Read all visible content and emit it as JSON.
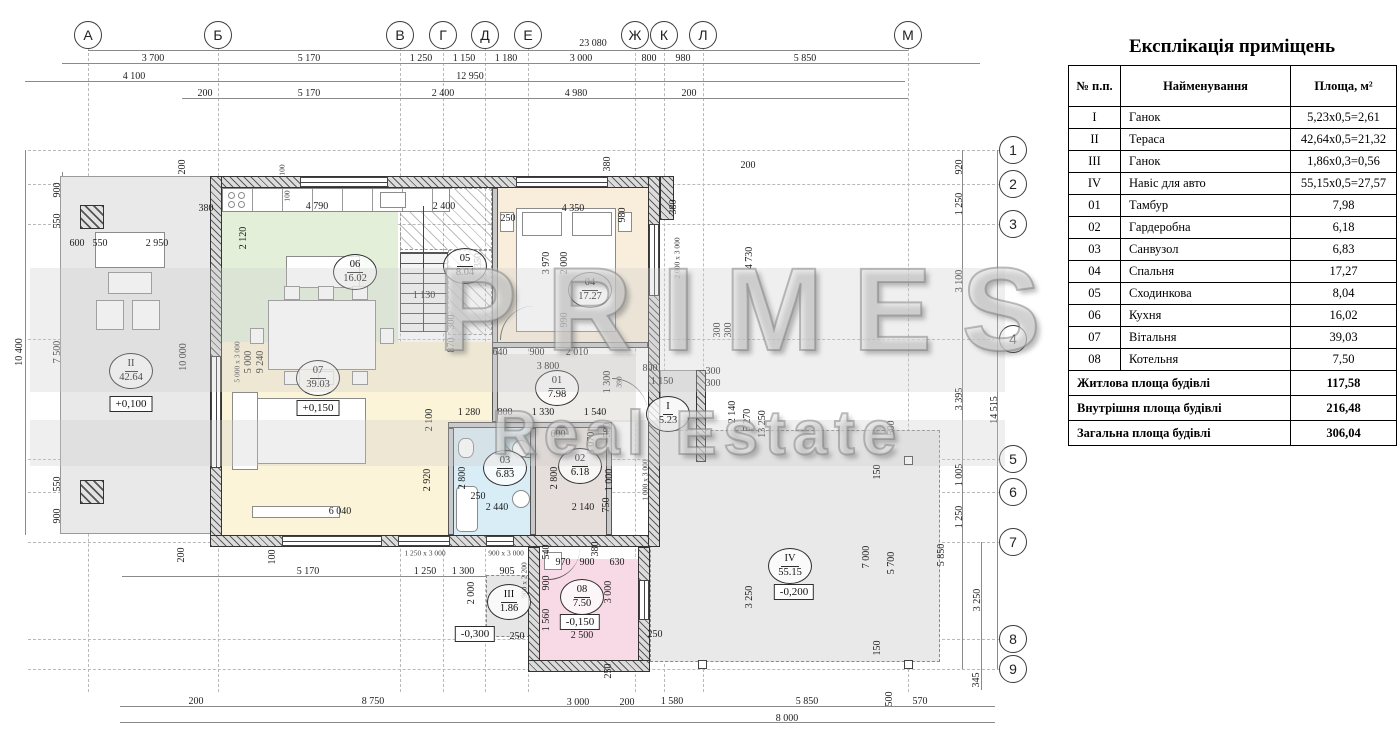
{
  "explication": {
    "title": "Експлікація приміщень",
    "headers": [
      "№ п.п.",
      "Найменування",
      "Площа, м²"
    ],
    "rows": [
      [
        "I",
        "Ганок",
        "5,23x0,5=2,61"
      ],
      [
        "II",
        "Тераса",
        "42,64x0,5=21,32"
      ],
      [
        "III",
        "Ганок",
        "1,86x0,3=0,56"
      ],
      [
        "IV",
        "Навіс для авто",
        "55,15x0,5=27,57"
      ],
      [
        "01",
        "Тамбур",
        "7,98"
      ],
      [
        "02",
        "Гардеробна",
        "6,18"
      ],
      [
        "03",
        "Санвузол",
        "6,83"
      ],
      [
        "04",
        "Спальня",
        "17,27"
      ],
      [
        "05",
        "Сходинкова",
        "8,04"
      ],
      [
        "06",
        "Кухня",
        "16,02"
      ],
      [
        "07",
        "Вітальня",
        "39,03"
      ],
      [
        "08",
        "Котельня",
        "7,50"
      ]
    ],
    "summary": [
      [
        "Житлова площа будівлі",
        "117,58"
      ],
      [
        "Внутрішня площа будівлі",
        "216,48"
      ],
      [
        "Загальна площа будівлі",
        "306,04"
      ]
    ]
  },
  "watermark": {
    "line1": "PRIMES",
    "line2": "Real Estate"
  },
  "axes": {
    "top": [
      {
        "label": "А",
        "x": 88
      },
      {
        "label": "Б",
        "x": 218
      },
      {
        "label": "В",
        "x": 400
      },
      {
        "label": "Г",
        "x": 443
      },
      {
        "label": "Д",
        "x": 485
      },
      {
        "label": "Е",
        "x": 528
      },
      {
        "label": "Ж",
        "x": 635
      },
      {
        "label": "К",
        "x": 664
      },
      {
        "label": "Л",
        "x": 703
      },
      {
        "label": "М",
        "x": 908
      }
    ],
    "right": [
      {
        "label": "1",
        "y": 150
      },
      {
        "label": "2",
        "y": 184
      },
      {
        "label": "3",
        "y": 224
      },
      {
        "label": "4",
        "y": 339
      },
      {
        "label": "5",
        "y": 459
      },
      {
        "label": "6",
        "y": 492
      },
      {
        "label": "7",
        "y": 542
      },
      {
        "label": "8",
        "y": 639
      },
      {
        "label": "9",
        "y": 669
      }
    ]
  },
  "rooms": [
    {
      "num": "06",
      "area": "16.02",
      "x": 355,
      "y": 272
    },
    {
      "num": "05",
      "area": "8.04",
      "x": 465,
      "y": 266
    },
    {
      "num": "04",
      "area": "17.27",
      "x": 590,
      "y": 290
    },
    {
      "num": "07",
      "area": "39.03",
      "x": 318,
      "y": 378
    },
    {
      "num": "01",
      "area": "7.98",
      "x": 557,
      "y": 388
    },
    {
      "num": "I",
      "area": "5.23",
      "x": 668,
      "y": 414
    },
    {
      "num": "03",
      "area": "6.83",
      "x": 505,
      "y": 468
    },
    {
      "num": "02",
      "area": "6.18",
      "x": 580,
      "y": 466
    },
    {
      "num": "08",
      "area": "7.50",
      "x": 582,
      "y": 597
    },
    {
      "num": "III",
      "area": "1.86",
      "x": 509,
      "y": 602
    },
    {
      "num": "IV",
      "area": "55.15",
      "x": 790,
      "y": 566
    },
    {
      "num": "II",
      "area": "42.64",
      "x": 131,
      "y": 371
    }
  ],
  "elevations": [
    {
      "text": "+0,100",
      "x": 131,
      "y": 404
    },
    {
      "text": "+0,150",
      "x": 318,
      "y": 408
    },
    {
      "text": "-0,150",
      "x": 580,
      "y": 622
    },
    {
      "text": "-0,300",
      "x": 475,
      "y": 634
    },
    {
      "text": "-0,200",
      "x": 794,
      "y": 592
    }
  ],
  "dims": [
    {
      "t": "23 080",
      "x": 593,
      "y": 44
    },
    {
      "t": "3 700",
      "x": 153,
      "y": 59
    },
    {
      "t": "5 170",
      "x": 309,
      "y": 59
    },
    {
      "t": "1 250",
      "x": 421,
      "y": 59
    },
    {
      "t": "1 150",
      "x": 464,
      "y": 59
    },
    {
      "t": "1 180",
      "x": 506,
      "y": 59
    },
    {
      "t": "3 000",
      "x": 581,
      "y": 59
    },
    {
      "t": "800",
      "x": 649,
      "y": 59
    },
    {
      "t": "980",
      "x": 683,
      "y": 59
    },
    {
      "t": "5 850",
      "x": 805,
      "y": 59
    },
    {
      "t": "4 100",
      "x": 134,
      "y": 77
    },
    {
      "t": "12 950",
      "x": 470,
      "y": 77
    },
    {
      "t": "200",
      "x": 205,
      "y": 94
    },
    {
      "t": "5 170",
      "x": 309,
      "y": 94
    },
    {
      "t": "2 400",
      "x": 443,
      "y": 94
    },
    {
      "t": "4 980",
      "x": 576,
      "y": 94
    },
    {
      "t": "200",
      "x": 689,
      "y": 94
    },
    {
      "t": "10 400",
      "x": 20,
      "y": 352,
      "r": 1
    },
    {
      "t": "900",
      "x": 58,
      "y": 190,
      "r": 1
    },
    {
      "t": "550",
      "x": 58,
      "y": 221,
      "r": 1
    },
    {
      "t": "7 500",
      "x": 58,
      "y": 352,
      "r": 1
    },
    {
      "t": "550",
      "x": 58,
      "y": 484,
      "r": 1
    },
    {
      "t": "900",
      "x": 58,
      "y": 516,
      "r": 1
    },
    {
      "t": "600",
      "x": 77,
      "y": 244
    },
    {
      "t": "550",
      "x": 100,
      "y": 244
    },
    {
      "t": "2 950",
      "x": 157,
      "y": 244
    },
    {
      "t": "200",
      "x": 183,
      "y": 167,
      "r": 1
    },
    {
      "t": "380",
      "x": 206,
      "y": 209
    },
    {
      "t": "10 000",
      "x": 184,
      "y": 357,
      "r": 1
    },
    {
      "t": "2 120",
      "x": 244,
      "y": 238,
      "r": 1
    },
    {
      "t": "100",
      "x": 282,
      "y": 170,
      "r": 1,
      "s": 1
    },
    {
      "t": "100",
      "x": 287,
      "y": 196,
      "r": 1,
      "s": 1
    },
    {
      "t": "4 790",
      "x": 317,
      "y": 207
    },
    {
      "t": "2 400",
      "x": 444,
      "y": 207
    },
    {
      "t": "380",
      "x": 608,
      "y": 164,
      "r": 1
    },
    {
      "t": "250",
      "x": 508,
      "y": 219
    },
    {
      "t": "4 350",
      "x": 573,
      "y": 209
    },
    {
      "t": "980",
      "x": 623,
      "y": 215,
      "r": 1
    },
    {
      "t": "380",
      "x": 674,
      "y": 207,
      "r": 1
    },
    {
      "t": "200",
      "x": 748,
      "y": 166
    },
    {
      "t": "3350",
      "x": 479,
      "y": 263,
      "r": 1
    },
    {
      "t": "1 130",
      "x": 424,
      "y": 296
    },
    {
      "t": "5 000 x 3 000",
      "x": 237,
      "y": 362,
      "r": 1,
      "s": 1
    },
    {
      "t": "5 000",
      "x": 249,
      "y": 362,
      "r": 1
    },
    {
      "t": "9 240",
      "x": 261,
      "y": 362,
      "r": 1
    },
    {
      "t": "300",
      "x": 452,
      "y": 322,
      "r": 1
    },
    {
      "t": "870",
      "x": 452,
      "y": 345,
      "r": 1
    },
    {
      "t": "2 100",
      "x": 430,
      "y": 420,
      "r": 1
    },
    {
      "t": "6 040",
      "x": 340,
      "y": 512
    },
    {
      "t": "3 970",
      "x": 547,
      "y": 263,
      "r": 1
    },
    {
      "t": "2 000",
      "x": 565,
      "y": 263,
      "r": 1
    },
    {
      "t": "2 000 x 3 000",
      "x": 677,
      "y": 258,
      "r": 1,
      "s": 1
    },
    {
      "t": "990",
      "x": 565,
      "y": 320,
      "r": 1
    },
    {
      "t": "4 730",
      "x": 750,
      "y": 258,
      "r": 1
    },
    {
      "t": "640",
      "x": 500,
      "y": 353
    },
    {
      "t": "900",
      "x": 537,
      "y": 353
    },
    {
      "t": "2 010",
      "x": 577,
      "y": 353
    },
    {
      "t": "3 800",
      "x": 548,
      "y": 367
    },
    {
      "t": "800",
      "x": 650,
      "y": 369
    },
    {
      "t": "1 150",
      "x": 662,
      "y": 382
    },
    {
      "t": "300",
      "x": 713,
      "y": 372
    },
    {
      "t": "300",
      "x": 713,
      "y": 384
    },
    {
      "t": "300",
      "x": 718,
      "y": 330,
      "r": 1
    },
    {
      "t": "300",
      "x": 729,
      "y": 330,
      "r": 1
    },
    {
      "t": "1 300",
      "x": 608,
      "y": 382,
      "r": 1
    },
    {
      "t": "390",
      "x": 619,
      "y": 382,
      "r": 1,
      "s": 1
    },
    {
      "t": "2 140",
      "x": 733,
      "y": 412,
      "r": 1
    },
    {
      "t": "5 270",
      "x": 748,
      "y": 420,
      "r": 1
    },
    {
      "t": "13 250",
      "x": 763,
      "y": 424,
      "r": 1
    },
    {
      "t": "1 280",
      "x": 469,
      "y": 413
    },
    {
      "t": "800",
      "x": 505,
      "y": 413
    },
    {
      "t": "1 330",
      "x": 543,
      "y": 413
    },
    {
      "t": "1 540",
      "x": 595,
      "y": 413
    },
    {
      "t": "2 920",
      "x": 428,
      "y": 480,
      "r": 1
    },
    {
      "t": "2 800",
      "x": 463,
      "y": 478,
      "r": 1
    },
    {
      "t": "600",
      "x": 558,
      "y": 435
    },
    {
      "t": "2 800",
      "x": 555,
      "y": 478,
      "r": 1
    },
    {
      "t": "5 070",
      "x": 592,
      "y": 443,
      "r": 1
    },
    {
      "t": "580",
      "x": 608,
      "y": 430,
      "r": 1
    },
    {
      "t": "1 000",
      "x": 610,
      "y": 480,
      "r": 1
    },
    {
      "t": "750",
      "x": 607,
      "y": 505,
      "r": 1
    },
    {
      "t": "250",
      "x": 478,
      "y": 497
    },
    {
      "t": "2 440",
      "x": 497,
      "y": 508
    },
    {
      "t": "2 140",
      "x": 583,
      "y": 508
    },
    {
      "t": "1 000 x 3 000",
      "x": 645,
      "y": 480,
      "r": 1,
      "s": 1
    },
    {
      "t": "100",
      "x": 273,
      "y": 557,
      "r": 1
    },
    {
      "t": "200",
      "x": 182,
      "y": 555,
      "r": 1
    },
    {
      "t": "1 250 x 3 000",
      "x": 425,
      "y": 553,
      "s": 1
    },
    {
      "t": "900 x 3 000",
      "x": 506,
      "y": 553,
      "s": 1
    },
    {
      "t": "5 170",
      "x": 308,
      "y": 572
    },
    {
      "t": "1 250",
      "x": 425,
      "y": 572
    },
    {
      "t": "1 300",
      "x": 463,
      "y": 572
    },
    {
      "t": "905",
      "x": 507,
      "y": 572
    },
    {
      "t": "900 x 2 200",
      "x": 524,
      "y": 580,
      "r": 1,
      "s": 1
    },
    {
      "t": "2 000",
      "x": 472,
      "y": 593,
      "r": 1
    },
    {
      "t": "540",
      "x": 547,
      "y": 552,
      "r": 1
    },
    {
      "t": "970",
      "x": 563,
      "y": 563
    },
    {
      "t": "900",
      "x": 587,
      "y": 563
    },
    {
      "t": "630",
      "x": 617,
      "y": 563
    },
    {
      "t": "380",
      "x": 596,
      "y": 549,
      "r": 1
    },
    {
      "t": "900",
      "x": 547,
      "y": 583,
      "r": 1
    },
    {
      "t": "1 560",
      "x": 547,
      "y": 620,
      "r": 1
    },
    {
      "t": "3 000",
      "x": 609,
      "y": 592,
      "r": 1
    },
    {
      "t": "2 500",
      "x": 582,
      "y": 636
    },
    {
      "t": "250",
      "x": 517,
      "y": 637
    },
    {
      "t": "250",
      "x": 655,
      "y": 635
    },
    {
      "t": "250",
      "x": 609,
      "y": 671,
      "r": 1
    },
    {
      "t": "200",
      "x": 196,
      "y": 702
    },
    {
      "t": "8 750",
      "x": 373,
      "y": 702
    },
    {
      "t": "3 000",
      "x": 578,
      "y": 703
    },
    {
      "t": "200",
      "x": 627,
      "y": 703
    },
    {
      "t": "1 580",
      "x": 672,
      "y": 702
    },
    {
      "t": "5 850",
      "x": 807,
      "y": 702
    },
    {
      "t": "500",
      "x": 890,
      "y": 699,
      "r": 1
    },
    {
      "t": "570",
      "x": 920,
      "y": 702
    },
    {
      "t": "8 000",
      "x": 787,
      "y": 719
    },
    {
      "t": "345",
      "x": 977,
      "y": 680,
      "r": 1
    },
    {
      "t": "3 250",
      "x": 750,
      "y": 597,
      "r": 1
    },
    {
      "t": "7 000",
      "x": 867,
      "y": 557,
      "r": 1
    },
    {
      "t": "5 700",
      "x": 892,
      "y": 563,
      "r": 1
    },
    {
      "t": "5 850",
      "x": 942,
      "y": 555,
      "r": 1
    },
    {
      "t": "150",
      "x": 878,
      "y": 472,
      "r": 1
    },
    {
      "t": "150",
      "x": 878,
      "y": 648,
      "r": 1
    },
    {
      "t": "500",
      "x": 892,
      "y": 428,
      "r": 1
    },
    {
      "t": "920",
      "x": 960,
      "y": 167,
      "r": 1
    },
    {
      "t": "1 250",
      "x": 960,
      "y": 204,
      "r": 1
    },
    {
      "t": "3 100",
      "x": 960,
      "y": 281,
      "r": 1
    },
    {
      "t": "3 395",
      "x": 960,
      "y": 399,
      "r": 1
    },
    {
      "t": "1 005",
      "x": 960,
      "y": 475,
      "r": 1
    },
    {
      "t": "1 250",
      "x": 960,
      "y": 517,
      "r": 1
    },
    {
      "t": "3 250",
      "x": 978,
      "y": 600,
      "r": 1
    },
    {
      "t": "14 515",
      "x": 995,
      "y": 410,
      "r": 1
    }
  ]
}
